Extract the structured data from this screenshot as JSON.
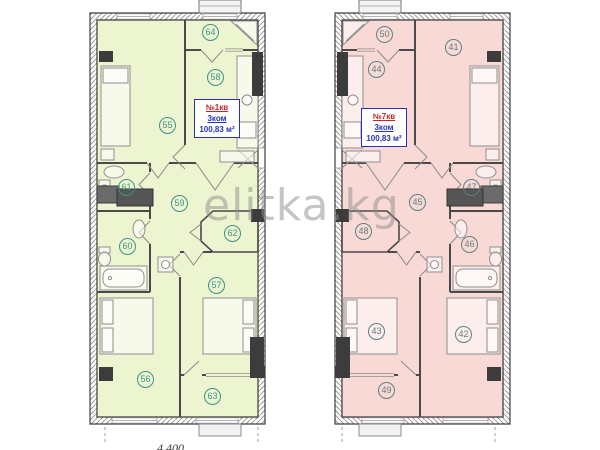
{
  "page": {
    "background": "#ffffff"
  },
  "watermark": {
    "text": "elitka.kg",
    "color": "#8c8c8c"
  },
  "footer": {
    "dimension_label": "4 400"
  },
  "colors": {
    "plan1_floor": "#edf4d0",
    "plan7_floor": "#f8d9d5",
    "plan1_circle": "#3c9488",
    "plan7_circle": "#5e8082",
    "label_number_red": "#c42525",
    "label_blue": "#2633b8",
    "wall_dark": "#4a4a4a",
    "column_black": "#3c3c3c"
  },
  "apartments": [
    {
      "id": "apartment-1",
      "label": {
        "number": "№1кв",
        "rooms_count": "3ком",
        "area": "100,83 м²"
      },
      "rooms": [
        {
          "name": "bedroom-main",
          "num": "55"
        },
        {
          "name": "bedroom-bottom",
          "num": "56"
        },
        {
          "name": "bedroom-middle",
          "num": "57"
        },
        {
          "name": "kitchen",
          "num": "58"
        },
        {
          "name": "hallway",
          "num": "59"
        },
        {
          "name": "bathroom-lower",
          "num": "60"
        },
        {
          "name": "bathroom-upper",
          "num": "61"
        },
        {
          "name": "wardrobe",
          "num": "62"
        },
        {
          "name": "balcony-bottom",
          "num": "63"
        },
        {
          "name": "loggia-top",
          "num": "64"
        }
      ]
    },
    {
      "id": "apartment-7",
      "label": {
        "number": "№7кв",
        "rooms_count": "3ком",
        "area": "100,83 м²"
      },
      "rooms": [
        {
          "name": "bedroom-main",
          "num": "41"
        },
        {
          "name": "bedroom-bottom",
          "num": "42"
        },
        {
          "name": "bedroom-middle",
          "num": "43"
        },
        {
          "name": "kitchen",
          "num": "44"
        },
        {
          "name": "hallway",
          "num": "45"
        },
        {
          "name": "bathroom-lower",
          "num": "46"
        },
        {
          "name": "bathroom-upper",
          "num": "47"
        },
        {
          "name": "wardrobe",
          "num": "48"
        },
        {
          "name": "balcony-bottom",
          "num": "49"
        },
        {
          "name": "loggia-top",
          "num": "50"
        }
      ]
    }
  ]
}
